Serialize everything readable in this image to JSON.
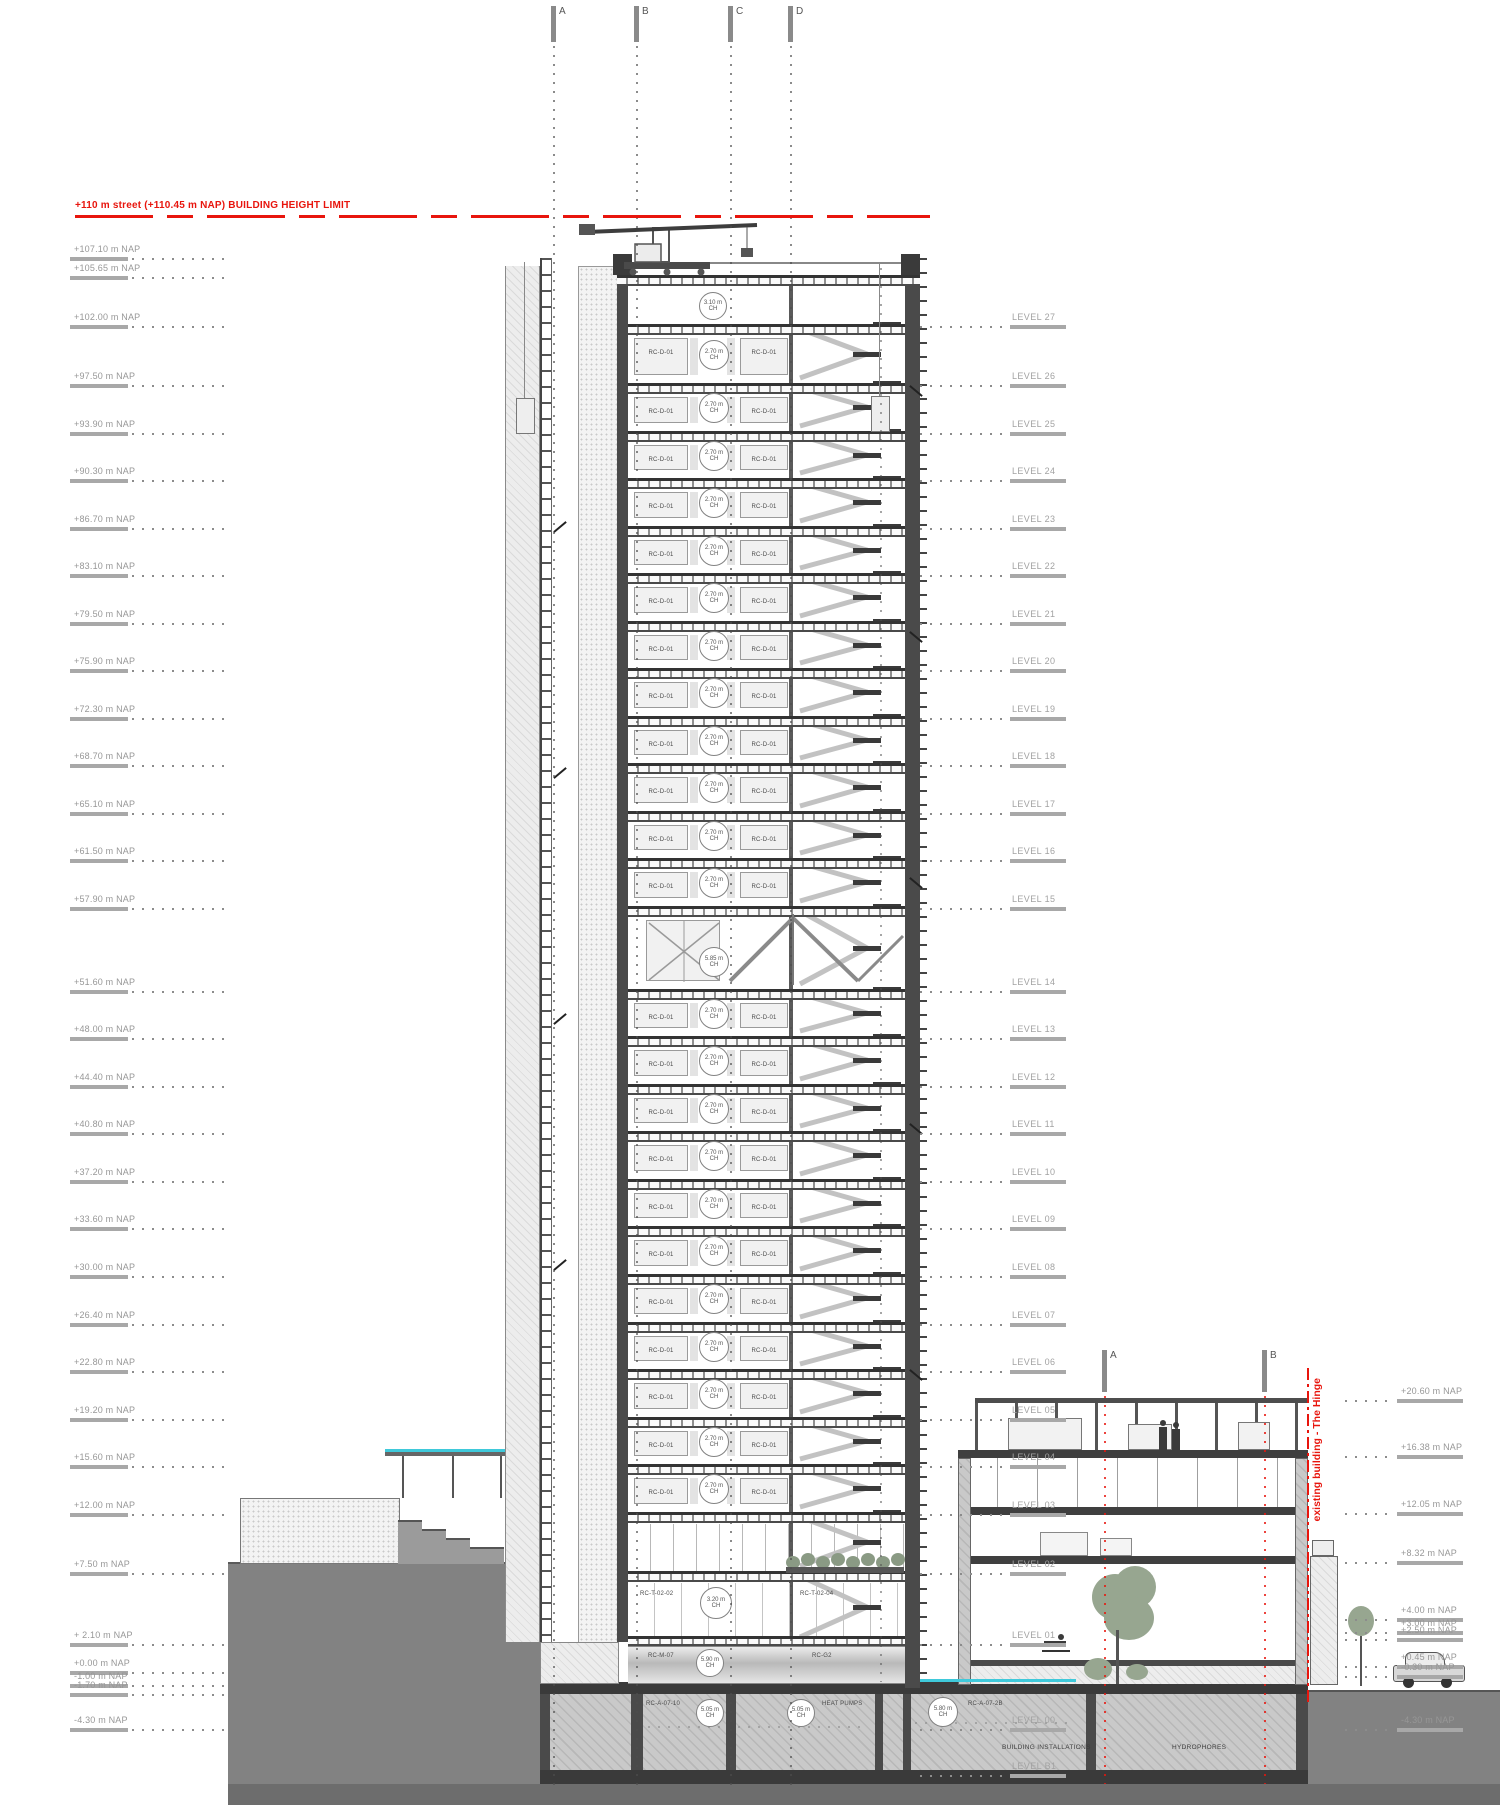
{
  "meta": {
    "height_limit_label": "+110 m street (+110.45 m NAP) BUILDING HEIGHT LIMIT",
    "red": "#e8150d"
  },
  "grid": {
    "top": [
      "A",
      "B",
      "C",
      "D"
    ],
    "right": [
      "A",
      "B"
    ]
  },
  "left_elevations": [
    {
      "label": "+107.10 m NAP",
      "elev": 107.1
    },
    {
      "label": "+105.65 m NAP",
      "elev": 105.65
    },
    {
      "label": "+102.00 m NAP",
      "elev": 102.0
    },
    {
      "label": "+97.50 m NAP",
      "elev": 97.5
    },
    {
      "label": "+93.90 m NAP",
      "elev": 93.9
    },
    {
      "label": "+90.30 m NAP",
      "elev": 90.3
    },
    {
      "label": "+86.70 m NAP",
      "elev": 86.7
    },
    {
      "label": "+83.10 m NAP",
      "elev": 83.1
    },
    {
      "label": "+79.50 m NAP",
      "elev": 79.5
    },
    {
      "label": "+75.90 m NAP",
      "elev": 75.9
    },
    {
      "label": "+72.30 m NAP",
      "elev": 72.3
    },
    {
      "label": "+68.70 m NAP",
      "elev": 68.7
    },
    {
      "label": "+65.10 m NAP",
      "elev": 65.1
    },
    {
      "label": "+61.50 m NAP",
      "elev": 61.5
    },
    {
      "label": "+57.90 m NAP",
      "elev": 57.9
    },
    {
      "label": "+51.60 m NAP",
      "elev": 51.6
    },
    {
      "label": "+48.00 m NAP",
      "elev": 48.0
    },
    {
      "label": "+44.40 m NAP",
      "elev": 44.4
    },
    {
      "label": "+40.80 m NAP",
      "elev": 40.8
    },
    {
      "label": "+37.20 m NAP",
      "elev": 37.2
    },
    {
      "label": "+33.60 m NAP",
      "elev": 33.6
    },
    {
      "label": "+30.00 m NAP",
      "elev": 30.0
    },
    {
      "label": "+26.40 m NAP",
      "elev": 26.4
    },
    {
      "label": "+22.80 m NAP",
      "elev": 22.8
    },
    {
      "label": "+19.20 m NAP",
      "elev": 19.2
    },
    {
      "label": "+15.60 m NAP",
      "elev": 15.6
    },
    {
      "label": "+12.00 m NAP",
      "elev": 12.0
    },
    {
      "label": "+7.50 m NAP",
      "elev": 7.5
    },
    {
      "label": "+ 2.10 m NAP",
      "elev": 2.1
    },
    {
      "label": "+0.00 m NAP",
      "elev": 0.0
    },
    {
      "label": "-1.00 m NAP",
      "elev": -1.0
    },
    {
      "label": "-1.70 m NAP",
      "elev": -1.7
    },
    {
      "label": "-4.30 m NAP",
      "elev": -4.3
    }
  ],
  "levels": [
    {
      "label": "LEVEL 27",
      "elev": 102.0
    },
    {
      "label": "LEVEL 26",
      "elev": 97.5
    },
    {
      "label": "LEVEL 25",
      "elev": 93.9
    },
    {
      "label": "LEVEL 24",
      "elev": 90.3
    },
    {
      "label": "LEVEL 23",
      "elev": 86.7
    },
    {
      "label": "LEVEL 22",
      "elev": 83.1
    },
    {
      "label": "LEVEL 21",
      "elev": 79.5
    },
    {
      "label": "LEVEL 20",
      "elev": 75.9
    },
    {
      "label": "LEVEL 19",
      "elev": 72.3
    },
    {
      "label": "LEVEL 18",
      "elev": 68.7
    },
    {
      "label": "LEVEL 17",
      "elev": 65.1
    },
    {
      "label": "LEVEL 16",
      "elev": 61.5
    },
    {
      "label": "LEVEL 15",
      "elev": 57.9
    },
    {
      "label": "LEVEL 14",
      "elev": 51.6
    },
    {
      "label": "LEVEL 13",
      "elev": 48.0
    },
    {
      "label": "LEVEL 12",
      "elev": 44.4
    },
    {
      "label": "LEVEL 11",
      "elev": 40.8
    },
    {
      "label": "LEVEL 10",
      "elev": 37.2
    },
    {
      "label": "LEVEL 09",
      "elev": 33.6
    },
    {
      "label": "LEVEL 08",
      "elev": 30.0
    },
    {
      "label": "LEVEL 07",
      "elev": 26.4
    },
    {
      "label": "LEVEL 06",
      "elev": 22.8
    },
    {
      "label": "LEVEL 05",
      "elev": 19.2
    },
    {
      "label": "LEVEL 04",
      "elev": 15.6
    },
    {
      "label": "LEVEL 03",
      "elev": 12.0
    },
    {
      "label": "LEVEL 02",
      "elev": 7.5
    },
    {
      "label": "LEVEL 01",
      "elev": 2.1
    },
    {
      "label": "LEVEL 00",
      "elev": -4.3
    },
    {
      "label": "LEVEL B1",
      "elev": -7.8
    }
  ],
  "right_elevations": [
    {
      "label": "+20.60 m NAP",
      "elev": 20.6
    },
    {
      "label": "+16.38 m NAP",
      "elev": 16.38
    },
    {
      "label": "+12.05 m NAP",
      "elev": 12.05
    },
    {
      "label": "+8.32 m NAP",
      "elev": 8.32
    },
    {
      "label": "+4.00 m NAP",
      "elev": 4.0
    },
    {
      "label": "+3.00 m NAP",
      "elev": 3.0
    },
    {
      "label": "+2.50 m NAP",
      "elev": 2.5
    },
    {
      "label": "+0.45 m NAP",
      "elev": 0.45
    },
    {
      "label": "-0.30 m NAP",
      "elev": -0.3
    },
    {
      "label": "-4.30 m NAP",
      "elev": -4.3
    }
  ],
  "tower": {
    "unit_label": "RC-D-01",
    "typ_ch": "2.70 m",
    "roof_ch": "3.10 m",
    "tall_ch": "5.85 m",
    "ch_suffix": "CH",
    "lobby_left": "RC-T-02-02",
    "lobby_ch": "3.20 m",
    "lobby_right": "RC-T-02-04",
    "mezz_left": "RC-M-07",
    "mezz_ch": "5.90 m",
    "mezz_right": "RC-G2"
  },
  "basement": {
    "room1_label": "RC-A-07-10",
    "room1_ch": "5.05 m",
    "room2_label": "HEAT PUMPS",
    "room2_ch": "5.05 m",
    "room3_label": "RC-A-07-2B",
    "room3_ch": "5.80 m",
    "installations_label": "BUILDING INSTALLATIONS",
    "hydrophores_label": "HYDROPHORES"
  },
  "annex": {
    "label": "existing building - The Hinge"
  }
}
